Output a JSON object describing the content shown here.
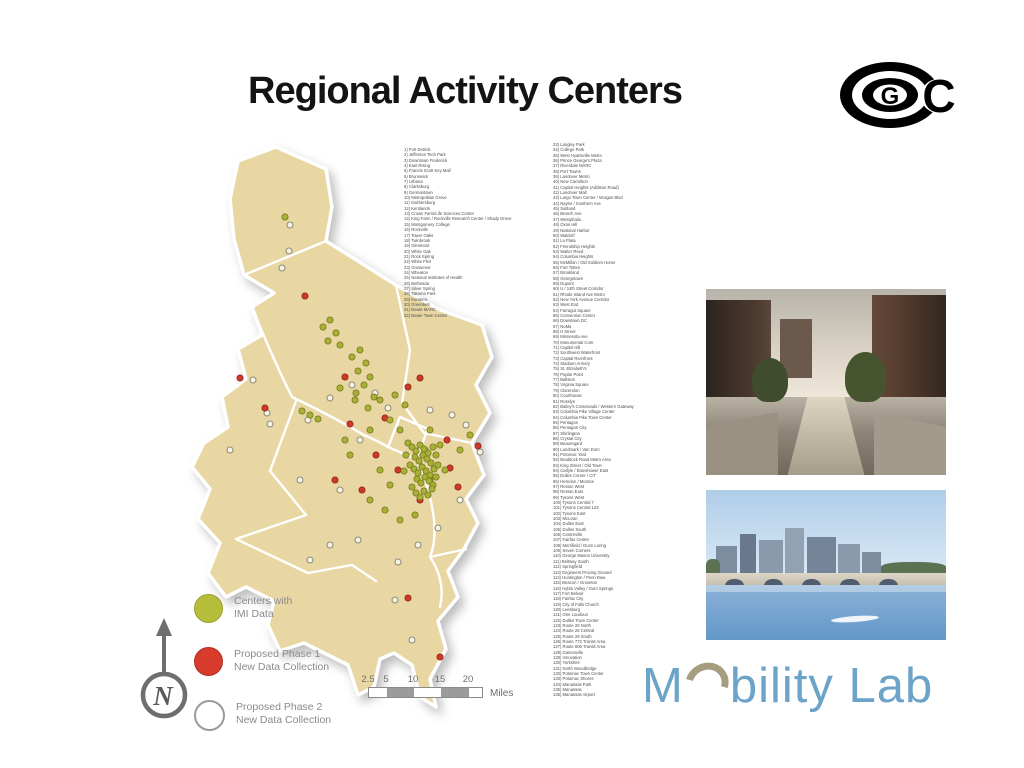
{
  "slide": {
    "title": "Regional Activity Centers"
  },
  "logos": {
    "cog": {
      "letter_g": "G",
      "letter_c": "C"
    },
    "mobility_lab": {
      "text_m": "M",
      "text_rest": "bility Lab",
      "color": "#6ba3c9",
      "swoosh_color": "#a69d80"
    }
  },
  "map": {
    "land_color": "#e8d7a3",
    "dot_colors": {
      "imi": "#a9b134",
      "imi_stroke": "#75781f",
      "phase1": "#cf3a28",
      "phase1_stroke": "#8f2418",
      "phase2_fill": "#f7f2e2",
      "phase2_stroke": "#8f8d7e"
    },
    "dots": [
      [
        102,
        123,
        "w"
      ],
      [
        109,
        106,
        "w"
      ],
      [
        73,
        235,
        "w"
      ],
      [
        87,
        268,
        "w"
      ],
      [
        90,
        279,
        "w"
      ],
      [
        128,
        275,
        "w"
      ],
      [
        150,
        253,
        "w"
      ],
      [
        172,
        240,
        "w"
      ],
      [
        195,
        248,
        "w"
      ],
      [
        208,
        263,
        "w"
      ],
      [
        180,
        295,
        "w"
      ],
      [
        250,
        265,
        "w"
      ],
      [
        272,
        270,
        "w"
      ],
      [
        286,
        280,
        "w"
      ],
      [
        300,
        307,
        "w"
      ],
      [
        280,
        355,
        "w"
      ],
      [
        258,
        383,
        "w"
      ],
      [
        238,
        400,
        "w"
      ],
      [
        218,
        417,
        "w"
      ],
      [
        178,
        395,
        "w"
      ],
      [
        150,
        400,
        "w"
      ],
      [
        130,
        415,
        "w"
      ],
      [
        232,
        495,
        "w"
      ],
      [
        215,
        455,
        "w"
      ],
      [
        160,
        345,
        "w"
      ],
      [
        50,
        305,
        "w"
      ],
      [
        120,
        335,
        "w"
      ],
      [
        110,
        80,
        "w"
      ],
      [
        125,
        151,
        "r"
      ],
      [
        60,
        233,
        "r"
      ],
      [
        85,
        263,
        "r"
      ],
      [
        165,
        232,
        "r"
      ],
      [
        170,
        279,
        "r"
      ],
      [
        196,
        310,
        "r"
      ],
      [
        228,
        242,
        "r"
      ],
      [
        240,
        233,
        "r"
      ],
      [
        267,
        295,
        "r"
      ],
      [
        270,
        323,
        "r"
      ],
      [
        298,
        301,
        "r"
      ],
      [
        155,
        335,
        "r"
      ],
      [
        182,
        345,
        "r"
      ],
      [
        278,
        342,
        "r"
      ],
      [
        228,
        453,
        "r"
      ],
      [
        260,
        512,
        "r"
      ],
      [
        205,
        273,
        "r"
      ],
      [
        218,
        325,
        "r"
      ],
      [
        240,
        355,
        "r"
      ],
      [
        160,
        243,
        "i"
      ],
      [
        175,
        255,
        "i"
      ],
      [
        188,
        263,
        "i"
      ],
      [
        200,
        255,
        "i"
      ],
      [
        215,
        250,
        "i"
      ],
      [
        225,
        260,
        "i"
      ],
      [
        210,
        275,
        "i"
      ],
      [
        190,
        285,
        "i"
      ],
      [
        220,
        285,
        "i"
      ],
      [
        250,
        285,
        "i"
      ],
      [
        260,
        300,
        "i"
      ],
      [
        245,
        305,
        "i"
      ],
      [
        200,
        325,
        "i"
      ],
      [
        210,
        340,
        "i"
      ],
      [
        190,
        355,
        "i"
      ],
      [
        205,
        365,
        "i"
      ],
      [
        220,
        375,
        "i"
      ],
      [
        235,
        370,
        "i"
      ],
      [
        170,
        310,
        "i"
      ],
      [
        165,
        295,
        "i"
      ],
      [
        250,
        335,
        "i"
      ],
      [
        265,
        325,
        "i"
      ],
      [
        280,
        305,
        "i"
      ],
      [
        290,
        290,
        "i"
      ],
      [
        130,
        270,
        "i"
      ],
      [
        122,
        266,
        "i"
      ],
      [
        138,
        274,
        "i"
      ],
      [
        180,
        205,
        "i"
      ],
      [
        172,
        212,
        "i"
      ],
      [
        186,
        218,
        "i"
      ],
      [
        178,
        226,
        "i"
      ],
      [
        190,
        232,
        "i"
      ],
      [
        184,
        240,
        "i"
      ],
      [
        176,
        248,
        "i"
      ],
      [
        194,
        252,
        "i"
      ],
      [
        150,
        175,
        "i"
      ],
      [
        143,
        182,
        "i"
      ],
      [
        156,
        188,
        "i"
      ],
      [
        148,
        196,
        "i"
      ],
      [
        160,
        200,
        "i"
      ],
      [
        105,
        72,
        "i"
      ],
      [
        228,
        298,
        "i"
      ],
      [
        232,
        302,
        "i"
      ],
      [
        236,
        306,
        "i"
      ],
      [
        240,
        300,
        "i"
      ],
      [
        244,
        304,
        "i"
      ],
      [
        248,
        308,
        "i"
      ],
      [
        235,
        312,
        "i"
      ],
      [
        239,
        316,
        "i"
      ],
      [
        243,
        310,
        "i"
      ],
      [
        247,
        314,
        "i"
      ],
      [
        251,
        318,
        "i"
      ],
      [
        230,
        320,
        "i"
      ],
      [
        234,
        324,
        "i"
      ],
      [
        238,
        328,
        "i"
      ],
      [
        242,
        322,
        "i"
      ],
      [
        246,
        326,
        "i"
      ],
      [
        250,
        330,
        "i"
      ],
      [
        254,
        324,
        "i"
      ],
      [
        237,
        334,
        "i"
      ],
      [
        241,
        338,
        "i"
      ],
      [
        245,
        332,
        "i"
      ],
      [
        249,
        336,
        "i"
      ],
      [
        253,
        340,
        "i"
      ],
      [
        232,
        342,
        "i"
      ],
      [
        244,
        346,
        "i"
      ],
      [
        248,
        350,
        "i"
      ],
      [
        252,
        344,
        "i"
      ],
      [
        240,
        352,
        "i"
      ],
      [
        236,
        348,
        "i"
      ],
      [
        256,
        332,
        "i"
      ],
      [
        258,
        320,
        "i"
      ],
      [
        226,
        310,
        "i"
      ],
      [
        224,
        326,
        "i"
      ],
      [
        256,
        310,
        "i"
      ],
      [
        253,
        302,
        "i"
      ]
    ]
  },
  "legend": {
    "items": [
      {
        "swatch": "imi",
        "lines": [
          "Centers with",
          "IMI Data"
        ]
      },
      {
        "swatch": "phase1",
        "lines": [
          "Proposed Phase 1",
          "New Data Collection"
        ]
      },
      {
        "swatch": "phase2",
        "lines": [
          "Proposed Phase 2",
          "New Data Collection"
        ]
      }
    ]
  },
  "compass": {
    "label": "N"
  },
  "scale_bar": {
    "ticks": [
      "2.5",
      "5",
      "10",
      "15",
      "20"
    ],
    "tick_positions": [
      0,
      18,
      45,
      72,
      100
    ],
    "segments": [
      {
        "w": 18,
        "g": false
      },
      {
        "w": 27,
        "g": true
      },
      {
        "w": 27,
        "g": false
      },
      {
        "w": 28,
        "g": true
      },
      {
        "w": 13,
        "g": false
      }
    ],
    "unit": "Miles"
  },
  "center_lists": {
    "column1": [
      "1) Fort Detrick",
      "2) Jefferson Tech Park",
      "3) Downtown Frederick",
      "4) East Rising",
      "5) Francis Scott Key Mall",
      "6) Brunswick",
      "7) Urbana",
      "8) Clarksburg",
      "9) Germantown",
      "10) Metropolitan Grove",
      "11) Gaithersburg",
      "12) Kentlands",
      "13) Crown Farm/Life Sciences Center",
      "14) King Farm / Rockville Research Center / Shady Grove",
      "15) Montgomery College",
      "16) Rockville",
      "17) Tower Oaks",
      "18) Twinbrook",
      "19) Glenmont",
      "20) White Oak",
      "21) Rock Spring",
      "22) White Flint",
      "23) Grosvenor",
      "24) Wheaton",
      "25) National Institutes of Health",
      "26) Bethesda",
      "27) Silver Spring",
      "28) Takoma Park",
      "29) Konterra",
      "30) Greenbelt",
      "31) Bowie MARC",
      "32) Bowie Town Center"
    ],
    "column2": [
      "33) Langley Park",
      "34) College Park",
      "35) West Hyattsville Metro",
      "36) Prince George's Plaza",
      "37) Riverdale MARC",
      "38) Port Towns",
      "39) Landover Metro",
      "40) New Carrollton",
      "41) Capitol Heights (Addison Road)",
      "42) Landover Mall",
      "43) Largo Town Center / Morgan Blvd",
      "44) Naylor / Southern Ave",
      "45) Suitland",
      "46) Branch Ave",
      "47) Westphalia",
      "48) Oxon Hill",
      "49) National Harbor",
      "50) Waldorf",
      "51) La Plata",
      "52) Friendship Heights",
      "53) Walter Reed",
      "54) Columbia Heights",
      "55) McMillan / Old Soldiers Home",
      "56) Fort Totten",
      "57) Brookland",
      "58) Georgetown",
      "59) Dupont",
      "60) U / 14th Street Corridor",
      "61) Rhode Island Ave Metro",
      "62) New York Avenue Corridor",
      "63) West End",
      "64) Farragut Square",
      "65) Convention Center",
      "66) Downtown DC",
      "67) NoMa",
      "68) H Street",
      "69) Minnesota Ave",
      "70) Monumental Core",
      "71) Capitol Hill",
      "72) Southwest Waterfront",
      "73) Capital Riverfront",
      "74) Stadium Armory",
      "75) St. Elizabeth's",
      "76) Poplar Point",
      "77) Ballston",
      "78) Virginia Square",
      "79) Clarendon",
      "80) Courthouse",
      "81) Rosslyn",
      "82) Bailey's Crossroads / Western Gateway",
      "83) Columbia Pike Village Center",
      "84) Columbia Pike Town Center",
      "85) Pentagon",
      "86) Pentagon City",
      "87) Shirlington",
      "88) Crystal City",
      "89) Beauregard",
      "90) Landmark / Van Dorn",
      "91) Potomac Yard",
      "92) Braddock Road Metro Area",
      "93) King Street / Old Town",
      "94) Carlyle / Eisenhower East",
      "95) Dulles Corner / CIT",
      "96) Herndon / Monroe",
      "97) Reston West",
      "98) Reston East",
      "99) Tysons West",
      "100) Tysons Central 7",
      "101) Tysons Central 123",
      "102) Tysons East",
      "103) McLean",
      "104) Dulles East",
      "105) Dulles South",
      "106) Centreville",
      "107) Fairfax Center",
      "108) Merrifield / Dunn Loring",
      "109) Seven Corners",
      "110) George Mason University",
      "111) Beltway South",
      "112) Springfield",
      "113) Engineers Proving Ground",
      "114) Huntington / Penn Daw",
      "115) Beacon / Groveton",
      "116) Hybla Valley / Gum Springs",
      "117) Fort Belvoir",
      "118) Fairfax City",
      "119) City of Falls Church",
      "120) Leesburg",
      "121) One Loudoun",
      "122) Dulles Town Center",
      "123) Route 28 North",
      "124) Route 28 Central",
      "125) Route 28 South",
      "126) Route 772 Transit Area",
      "127) Route 606 Transit Area",
      "128) Gainesville",
      "129) Innovation",
      "130) Yorkshire",
      "131) North Woodbridge",
      "132) Potomac Town Center",
      "133) Potomac Shores",
      "134) Manassas Park",
      "135) Manassas",
      "136) Manassas Airport"
    ]
  },
  "photos": [
    {
      "name": "canal-street-scene"
    },
    {
      "name": "river-bridge-skyline"
    }
  ]
}
